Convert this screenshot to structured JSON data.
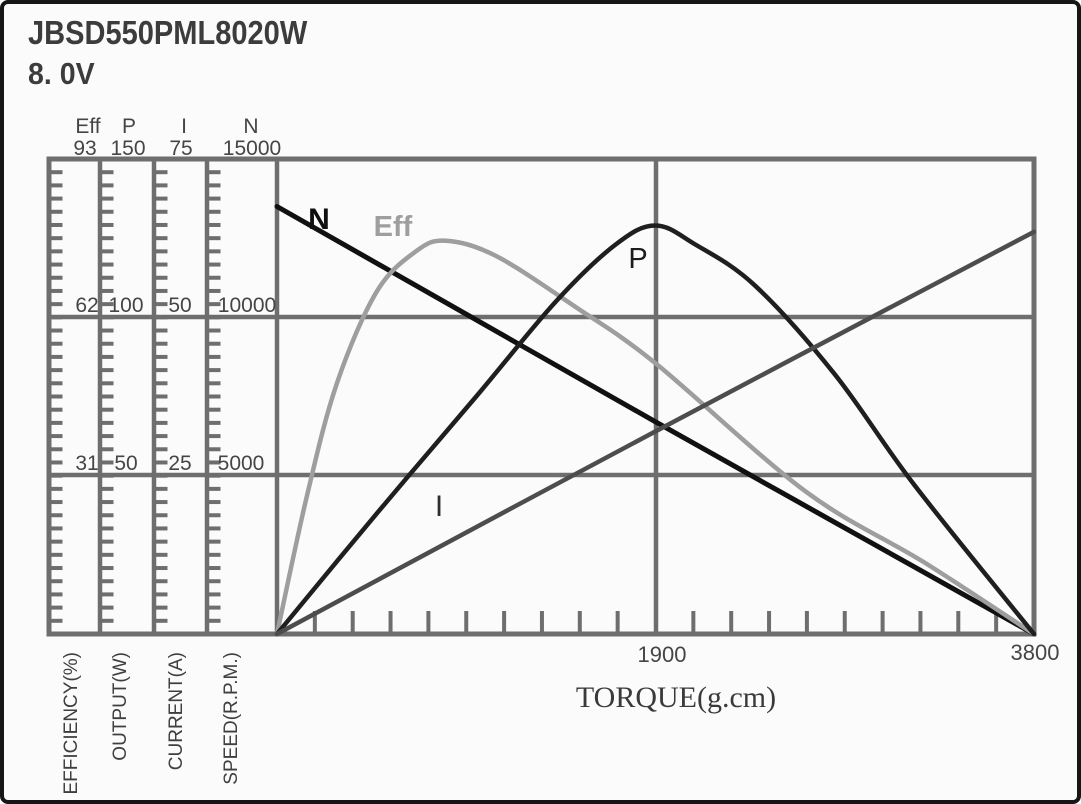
{
  "header": {
    "model": "JBSD550PML8020W",
    "voltage": "8. 0V"
  },
  "chart_data": {
    "type": "line",
    "title": "JBSD550PML8020W",
    "subtitle": "8. 0V",
    "xlabel": "TORQUE(g.cm)",
    "x_range": [
      0,
      3800
    ],
    "x_tick_labels": [
      "1900",
      "3800"
    ],
    "grid": "on",
    "legend_position": "labels-on-curves",
    "axes": [
      {
        "name": "Eff",
        "unit_label": "EFFICIENCY(%)",
        "max": 93,
        "tick_values": [
          "93",
          "62",
          "31"
        ]
      },
      {
        "name": "P",
        "unit_label": "OUTPUT(W)",
        "max": 150,
        "tick_values": [
          "150",
          "100",
          "50"
        ]
      },
      {
        "name": "I",
        "unit_label": "CURRENT(A)",
        "max": 75,
        "tick_values": [
          "75",
          "50",
          "25"
        ]
      },
      {
        "name": "N",
        "unit_label": "SPEED(R.P.M.)",
        "max": 15000,
        "tick_values": [
          "15000",
          "10000",
          "5000"
        ]
      }
    ],
    "series": [
      {
        "name": "N",
        "axis": "N",
        "color": "#111111",
        "points": [
          [
            0,
            13500
          ],
          [
            950,
            10100
          ],
          [
            1900,
            6700
          ],
          [
            2850,
            3350
          ],
          [
            3800,
            0
          ]
        ]
      },
      {
        "name": "Eff",
        "axis": "Eff",
        "color": "#9e9e9e",
        "points": [
          [
            0,
            0
          ],
          [
            150,
            27
          ],
          [
            300,
            49
          ],
          [
            500,
            67
          ],
          [
            700,
            75
          ],
          [
            850,
            77
          ],
          [
            1100,
            74
          ],
          [
            1500,
            64
          ],
          [
            1900,
            53
          ],
          [
            2650,
            28
          ],
          [
            3250,
            14
          ],
          [
            3800,
            0
          ]
        ]
      },
      {
        "name": "P",
        "axis": "P",
        "color": "#1f1f1f",
        "points": [
          [
            0,
            0
          ],
          [
            500,
            38
          ],
          [
            1000,
            75
          ],
          [
            1400,
            105
          ],
          [
            1700,
            123
          ],
          [
            1900,
            129
          ],
          [
            2100,
            123
          ],
          [
            2400,
            110
          ],
          [
            2800,
            82
          ],
          [
            3200,
            47
          ],
          [
            3800,
            0
          ]
        ]
      },
      {
        "name": "I",
        "axis": "I",
        "color": "#4d4d4d",
        "points": [
          [
            0,
            0
          ],
          [
            1900,
            32
          ],
          [
            3800,
            63.5
          ]
        ]
      }
    ]
  },
  "colors": {
    "grid": "#6e6e6e",
    "axis_text": "#454545"
  }
}
